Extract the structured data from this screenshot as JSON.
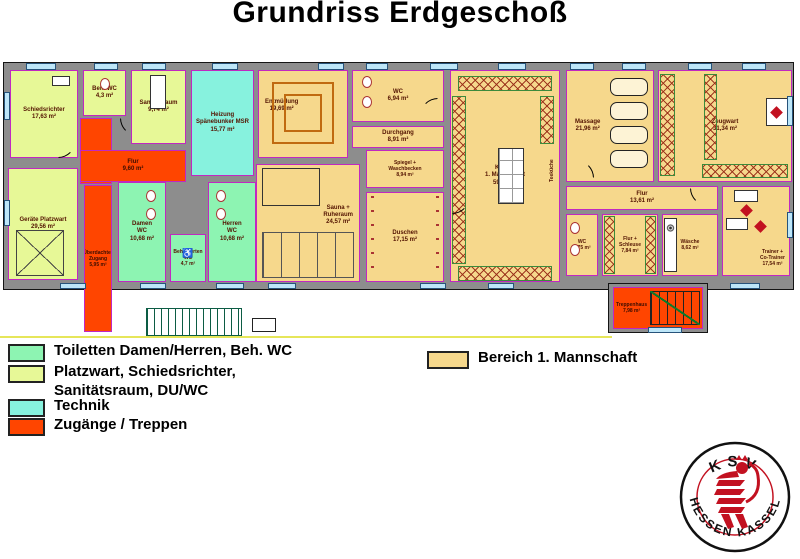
{
  "title": "Grundriss Erdgeschoß",
  "legend": {
    "items": [
      {
        "label": "Toiletten Damen/Herren, Beh. WC",
        "color": "#8df4b2"
      },
      {
        "label": "Platzwart, Schiedsrichter,\nSanitätsraum, DU/WC",
        "color": "#e7f897"
      },
      {
        "label": "Technik",
        "color": "#87f2de"
      },
      {
        "label": "Zugänge / Treppen",
        "color": "#ff4500"
      }
    ],
    "team_area": {
      "label": "Bereich 1. Mannschaft",
      "color": "#f6d88c"
    }
  },
  "rooms": {
    "schiedsrichter": {
      "label": "Schiedsrichter\n17,63 m²"
    },
    "beh_wc": {
      "label": "Beh. WC\n4,3 m²"
    },
    "sanitaetsraum": {
      "label": "Sanitätsraum\n9,74 m²"
    },
    "heizung": {
      "label": "Heizung\nSpänebunker MSR\n15,77 m²"
    },
    "flur_links": {
      "label": "Flur\n9,60 m²"
    },
    "geraete_platzwart": {
      "label": "Geräte Platzwart\n29,56 m²"
    },
    "ueberdachter_zugang": {
      "label": "Überdachter\nZugang\n5,95 m²"
    },
    "damen_wc": {
      "label": "Damen\nWC\n10,68 m²"
    },
    "behinderten_wc": {
      "label": "Behinderten\nWC\n4,7 m²"
    },
    "herren_wc": {
      "label": "Herren\nWC\n10,68 m²"
    },
    "entmuedung": {
      "label": "Entmüdung\n19,69 m²"
    },
    "wc_mannschaft": {
      "label": "WC\n6,94 m²"
    },
    "durchgang": {
      "label": "Durchgang\n8,91 m²"
    },
    "spiegel_waschbecken": {
      "label": "Spiegel +\nWaschbecken\n8,94 m²"
    },
    "sauna_ruheraum": {
      "label": "Sauna +\nRuheraum\n24,57 m²"
    },
    "duschen": {
      "label": "Duschen\n17,15 m²"
    },
    "kabine": {
      "label": "Kabine\n1. Mannschaft\n59,09 m²"
    },
    "teekueche": {
      "label": "Teeküche"
    },
    "massage": {
      "label": "Massage\n21,96 m²"
    },
    "zeugwart": {
      "label": "Zeugwart\n31,34 m²"
    },
    "flur_rechts": {
      "label": "Flur\n13,61 m²"
    },
    "wc_trainerbereich": {
      "label": "WC\n4,75 m²"
    },
    "flur_schleuse": {
      "label": "Flur +\nSchleuse\n7,84 m²"
    },
    "waesche": {
      "label": "Wäsche\n8,62 m²"
    },
    "trainer": {
      "label": "Trainer +\nCo-Trainer\n17,54 m²"
    },
    "treppenhaus": {
      "label": "Treppenhaus\n7,98 m²"
    }
  },
  "logo": {
    "top": "KSV",
    "bottom": "HESSEN  KASSEL"
  },
  "colors": {
    "wall": "#8d8d8d",
    "room_border": "#c128c1",
    "window": "#bde6f8",
    "site_line": "#e6e65a",
    "logo_red": "#c21120",
    "entry": "#ff4500",
    "team": "#f6d88c",
    "toilets": "#8df4b2",
    "platzwart": "#e7f897",
    "technik": "#87f2de"
  }
}
